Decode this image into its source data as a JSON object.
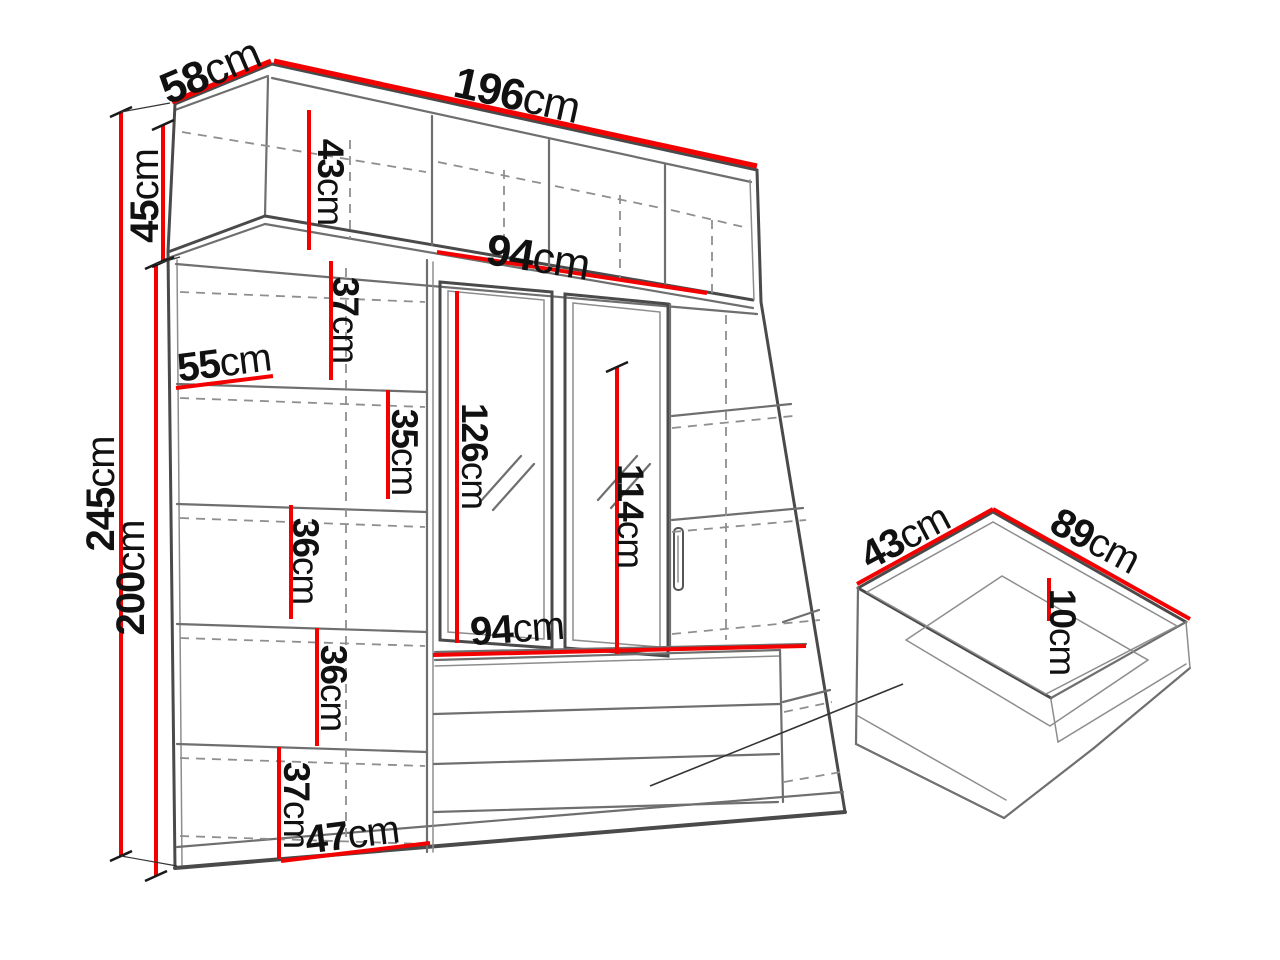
{
  "diagram": {
    "type": "furniture-dimension-drawing",
    "background": "#ffffff",
    "accent_red": "#f30000",
    "line_dark": "#4a4a4a",
    "line_light": "#8f8f8f",
    "text_color": "#111111"
  },
  "dims": {
    "d58": {
      "value": "58",
      "unit": "cm"
    },
    "d196": {
      "value": "196",
      "unit": "cm"
    },
    "d45": {
      "value": "45",
      "unit": "cm"
    },
    "d245": {
      "value": "245",
      "unit": "cm"
    },
    "d200": {
      "value": "200",
      "unit": "cm"
    },
    "d43top": {
      "value": "43",
      "unit": "cm"
    },
    "d94top": {
      "value": "94",
      "unit": "cm"
    },
    "d37a": {
      "value": "37",
      "unit": "cm"
    },
    "d55": {
      "value": "55",
      "unit": "cm"
    },
    "d35": {
      "value": "35",
      "unit": "cm"
    },
    "d126": {
      "value": "126",
      "unit": "cm"
    },
    "d114": {
      "value": "114",
      "unit": "cm"
    },
    "d36a": {
      "value": "36",
      "unit": "cm"
    },
    "d36b": {
      "value": "36",
      "unit": "cm"
    },
    "d94bot": {
      "value": "94",
      "unit": "cm"
    },
    "d37b": {
      "value": "37",
      "unit": "cm"
    },
    "d47": {
      "value": "47",
      "unit": "cm"
    },
    "drw43": {
      "value": "43",
      "unit": "cm"
    },
    "drw89": {
      "value": "89",
      "unit": "cm"
    },
    "drw10": {
      "value": "10",
      "unit": "cm"
    }
  }
}
